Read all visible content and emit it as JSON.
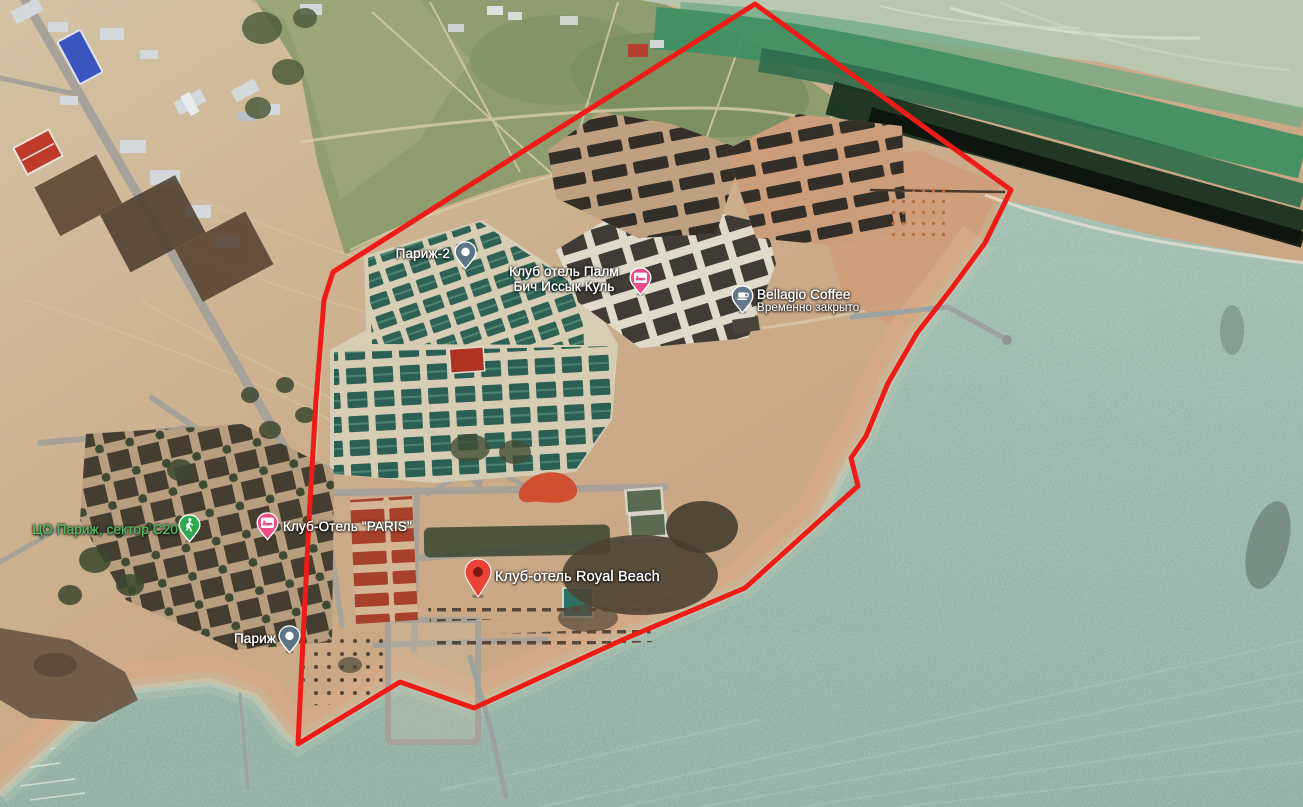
{
  "app": {
    "name": "Satellite map view"
  },
  "map": {
    "imagery": "satellite",
    "outline_color": "#ee1c16",
    "water_color": "#93b2a5",
    "sand_color": "#cbab8a",
    "label_green": "#56bb62",
    "labels": [
      {
        "name": "Париж-2",
        "pin": "place-pin",
        "pin_color": "#5b7587"
      },
      {
        "name": "Клуб отель Палм Бич Иссык Куль",
        "pin": "hotel-pin",
        "pin_color": "#ec4d86"
      },
      {
        "name": "Bellagio Coffee",
        "status": "Временно закрыто",
        "pin": "cafe-pin",
        "pin_color": "#65798a"
      },
      {
        "name": "ЦО Париж, сектор C20",
        "pin": "attraction-pin",
        "pin_color": "#2fa84f",
        "text_color": "#56bb62"
      },
      {
        "name": "Клуб-Отель \"PARIS\"",
        "pin": "hotel-pin",
        "pin_color": "#ec4d86"
      },
      {
        "name": "Клуб-отель Royal Beach",
        "pin": "red-marker",
        "pin_color": "#ea4335"
      },
      {
        "name": "Париж",
        "pin": "place-pin",
        "pin_color": "#5b7587"
      }
    ]
  }
}
